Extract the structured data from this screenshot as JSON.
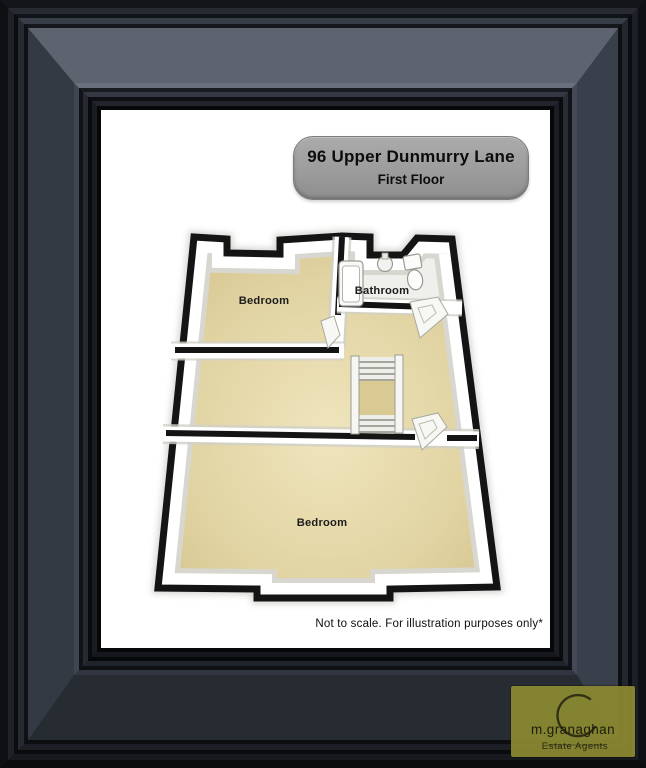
{
  "plate": {
    "address": "96 Upper Dunmurry Lane",
    "floor_label": "First Floor"
  },
  "floorplan": {
    "rooms": [
      {
        "label": "Bedroom"
      },
      {
        "label": "Bathroom"
      },
      {
        "label": "Bedroom"
      }
    ],
    "fixtures": [
      "bathtub",
      "sink",
      "toilet",
      "staircase",
      "door",
      "door",
      "door"
    ]
  },
  "footer": {
    "disclaimer": "Not to scale. For illustration purposes only*"
  },
  "logo": {
    "brand": "m.granaghan",
    "tagline": "Estate Agents"
  },
  "colors": {
    "frame_band_top": "#5d6470",
    "plate_gray": "#9c9c9c",
    "floor_tan": "#e2d5a4",
    "bathroom_floor": "#efefec",
    "wall_black": "#141414",
    "logo_olive": "#8c8a33",
    "accent_teal": "#b2d8dc"
  }
}
